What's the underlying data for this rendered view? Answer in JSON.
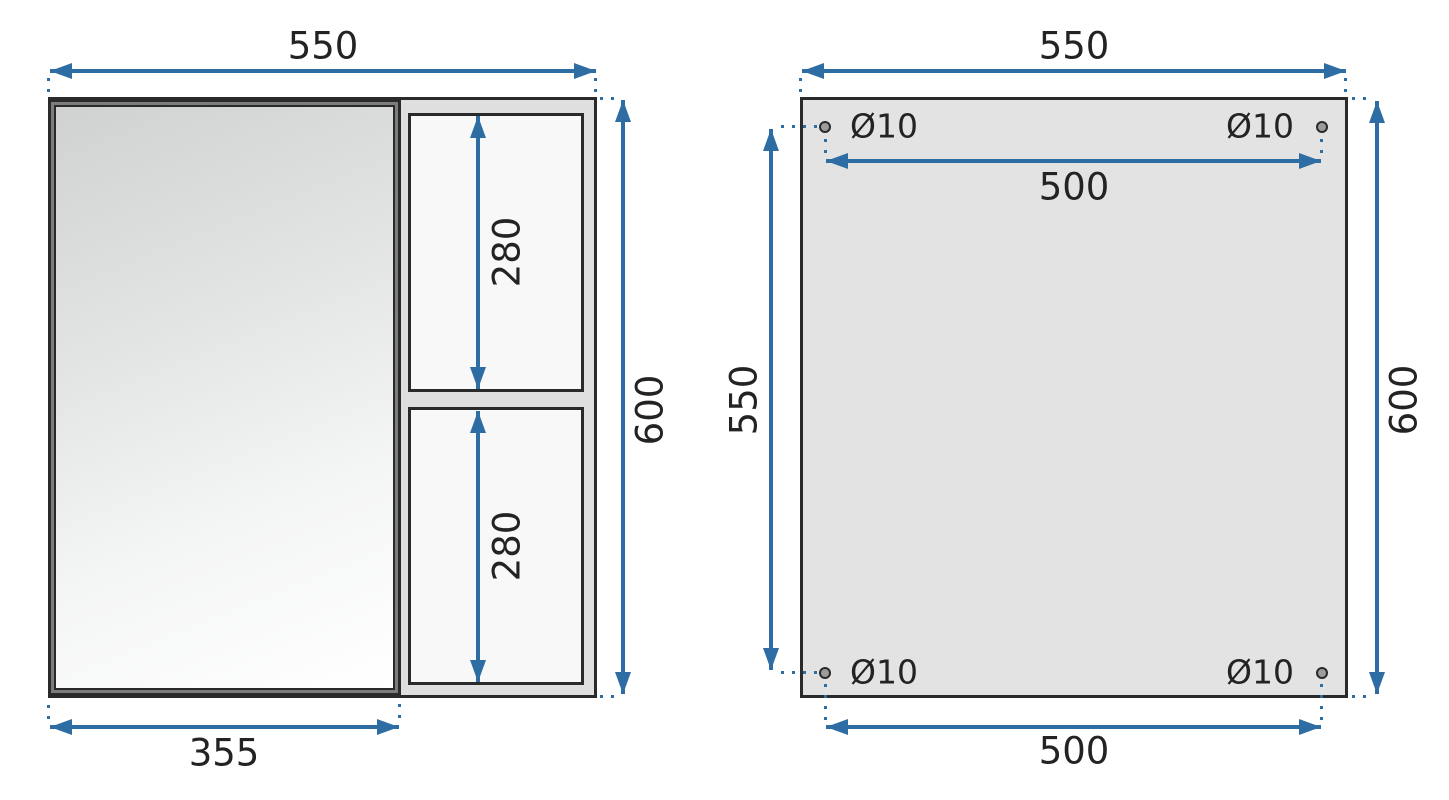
{
  "colors": {
    "accent": "#2e6ca4",
    "outline": "#2a2a2a",
    "text": "#232323",
    "carcass_fill": "#dfdfdf",
    "opening_fill": "#f8f8f8",
    "panel_fill": "#e3e3e3",
    "door_frame": "#7d7d7d",
    "mirror_from": "#d0d2d1",
    "mirror_to": "#ffffff",
    "hole_fill": "#9c9c9c"
  },
  "front_view": {
    "dim_overall_width": "550",
    "dim_overall_height": "600",
    "dim_door_width": "355",
    "dim_shelf_top_height": "280",
    "dim_shelf_bottom_height": "280"
  },
  "back_view": {
    "dim_overall_width": "550",
    "dim_overall_height": "600",
    "dim_hole_span_top": "500",
    "dim_hole_span_bottom": "500",
    "dim_hole_vertical_span": "550",
    "hole_top_left": "Ø10",
    "hole_top_right": "Ø10",
    "hole_bottom_left": "Ø10",
    "hole_bottom_right": "Ø10"
  }
}
